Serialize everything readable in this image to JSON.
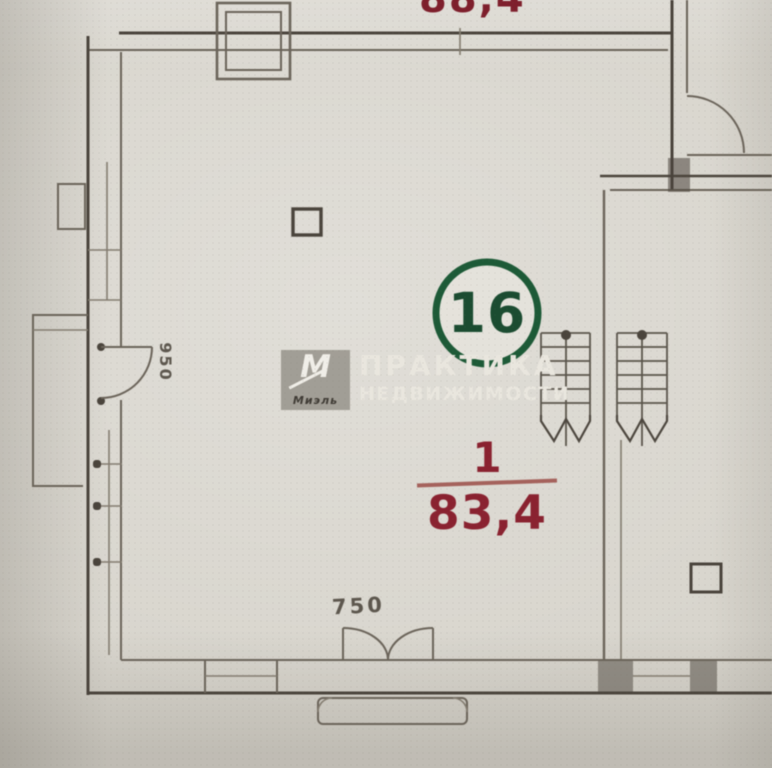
{
  "floorplan": {
    "upper_area_label": "88,4",
    "unit_number": "16",
    "room_index": "1",
    "room_area": "83,4",
    "dim_left": "950",
    "dim_bottom": "750"
  },
  "watermark": {
    "monogram": "М",
    "brand": "Миэль",
    "line1": "ПРАКТИКА",
    "line2": "НЕДВИЖИМОСТИ"
  },
  "colors": {
    "paper": "#d8d5cd",
    "ink": "#6b645a",
    "ink_dark": "#4a443c",
    "area_red": "#8a2230",
    "badge_green": "#1d5a37",
    "watermark_text": "#e9e6de",
    "watermark_tile": "#949088"
  }
}
